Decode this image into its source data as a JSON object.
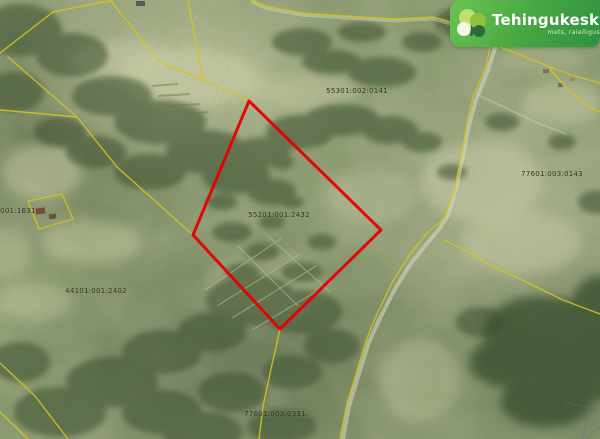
{
  "logo": {
    "name": "Tehingukeskus",
    "tagline": "mets, raieõigus, põld",
    "brand_color": "#3f9f3e"
  },
  "map": {
    "selected_parcel": {
      "code": "55201:001:2432",
      "outline_color": "#e60000"
    },
    "boundary_color": "#d4c41e",
    "parcel_labels": [
      {
        "text": "55301:002:0141"
      },
      {
        "text": "77601:003:0143"
      },
      {
        "text": "55201:001:2432"
      },
      {
        "text": "55201:001:1631"
      },
      {
        "text": "44101:001:2402"
      },
      {
        "text": "77601:003:0331"
      }
    ]
  }
}
